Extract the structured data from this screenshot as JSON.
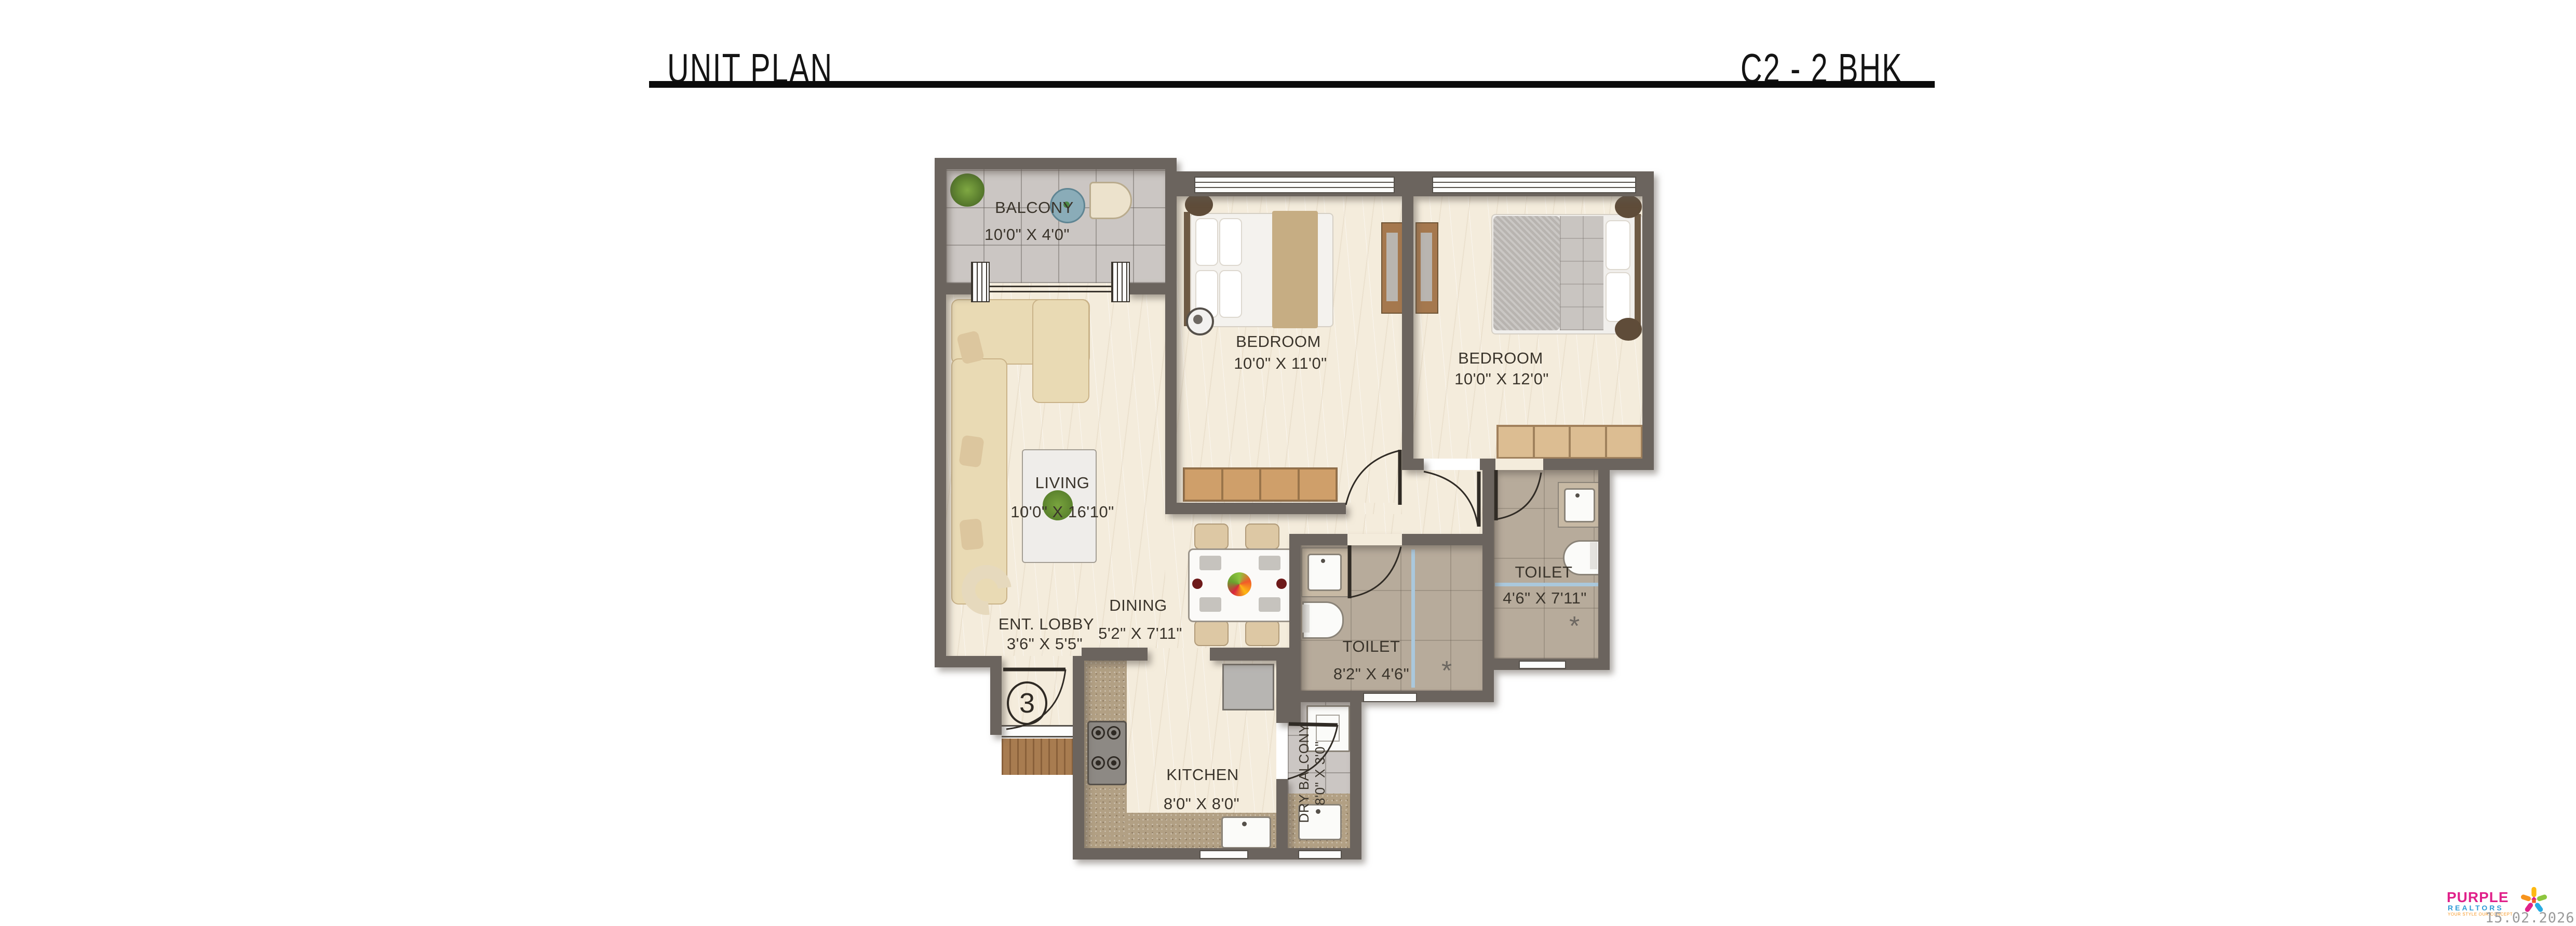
{
  "header": {
    "title": "UNIT PLAN",
    "unit_label": "C2 - 2 BHK"
  },
  "rooms": {
    "balcony": {
      "name": "BALCONY",
      "dims": "10'0\" X 4'0\""
    },
    "living": {
      "name": "LIVING",
      "dims": "10'0\" X 16'10\""
    },
    "bedroom1": {
      "name": "BEDROOM",
      "dims": "10'0\" X 11'0\""
    },
    "bedroom2": {
      "name": "BEDROOM",
      "dims": "10'0\" X 12'0\""
    },
    "dining": {
      "name": "DINING",
      "dims": "5'2\" X 7'11\""
    },
    "ent_lobby": {
      "name": "ENT. LOBBY",
      "dims": "3'6\" X 5'5\""
    },
    "toilet1": {
      "name": "TOILET",
      "dims": "8'2\" X 4'6\""
    },
    "toilet2": {
      "name": "TOILET",
      "dims": "4'6\" X 7'11\""
    },
    "kitchen": {
      "name": "KITCHEN",
      "dims": "8'0\" X 8'0\""
    },
    "dry_balcony": {
      "name": "DRY BALCONY",
      "dims": "8'0\" X 3'0\""
    }
  },
  "entrance": {
    "unit_number": "3"
  },
  "watermark": {
    "brand_top": "PURPLE",
    "brand_bottom": "REALTORS",
    "tagline": "YOUR STYLE OUR CONCEPT",
    "date": "15.02.2026"
  },
  "colors": {
    "wall": "#6b645e",
    "floor_marble": "#f4ecdc",
    "balcony_tile": "#cbc6c3",
    "toilet_tile": "#b7ab9b",
    "counter_granite": "#b2a084",
    "wood": "#a87c50",
    "glass_partition": "#aac8dc",
    "brand_pink": "#e0218a",
    "brand_blue": "#2e9bd6",
    "tagline_orange": "#f7941d",
    "date_gray": "#9a9a9a"
  }
}
